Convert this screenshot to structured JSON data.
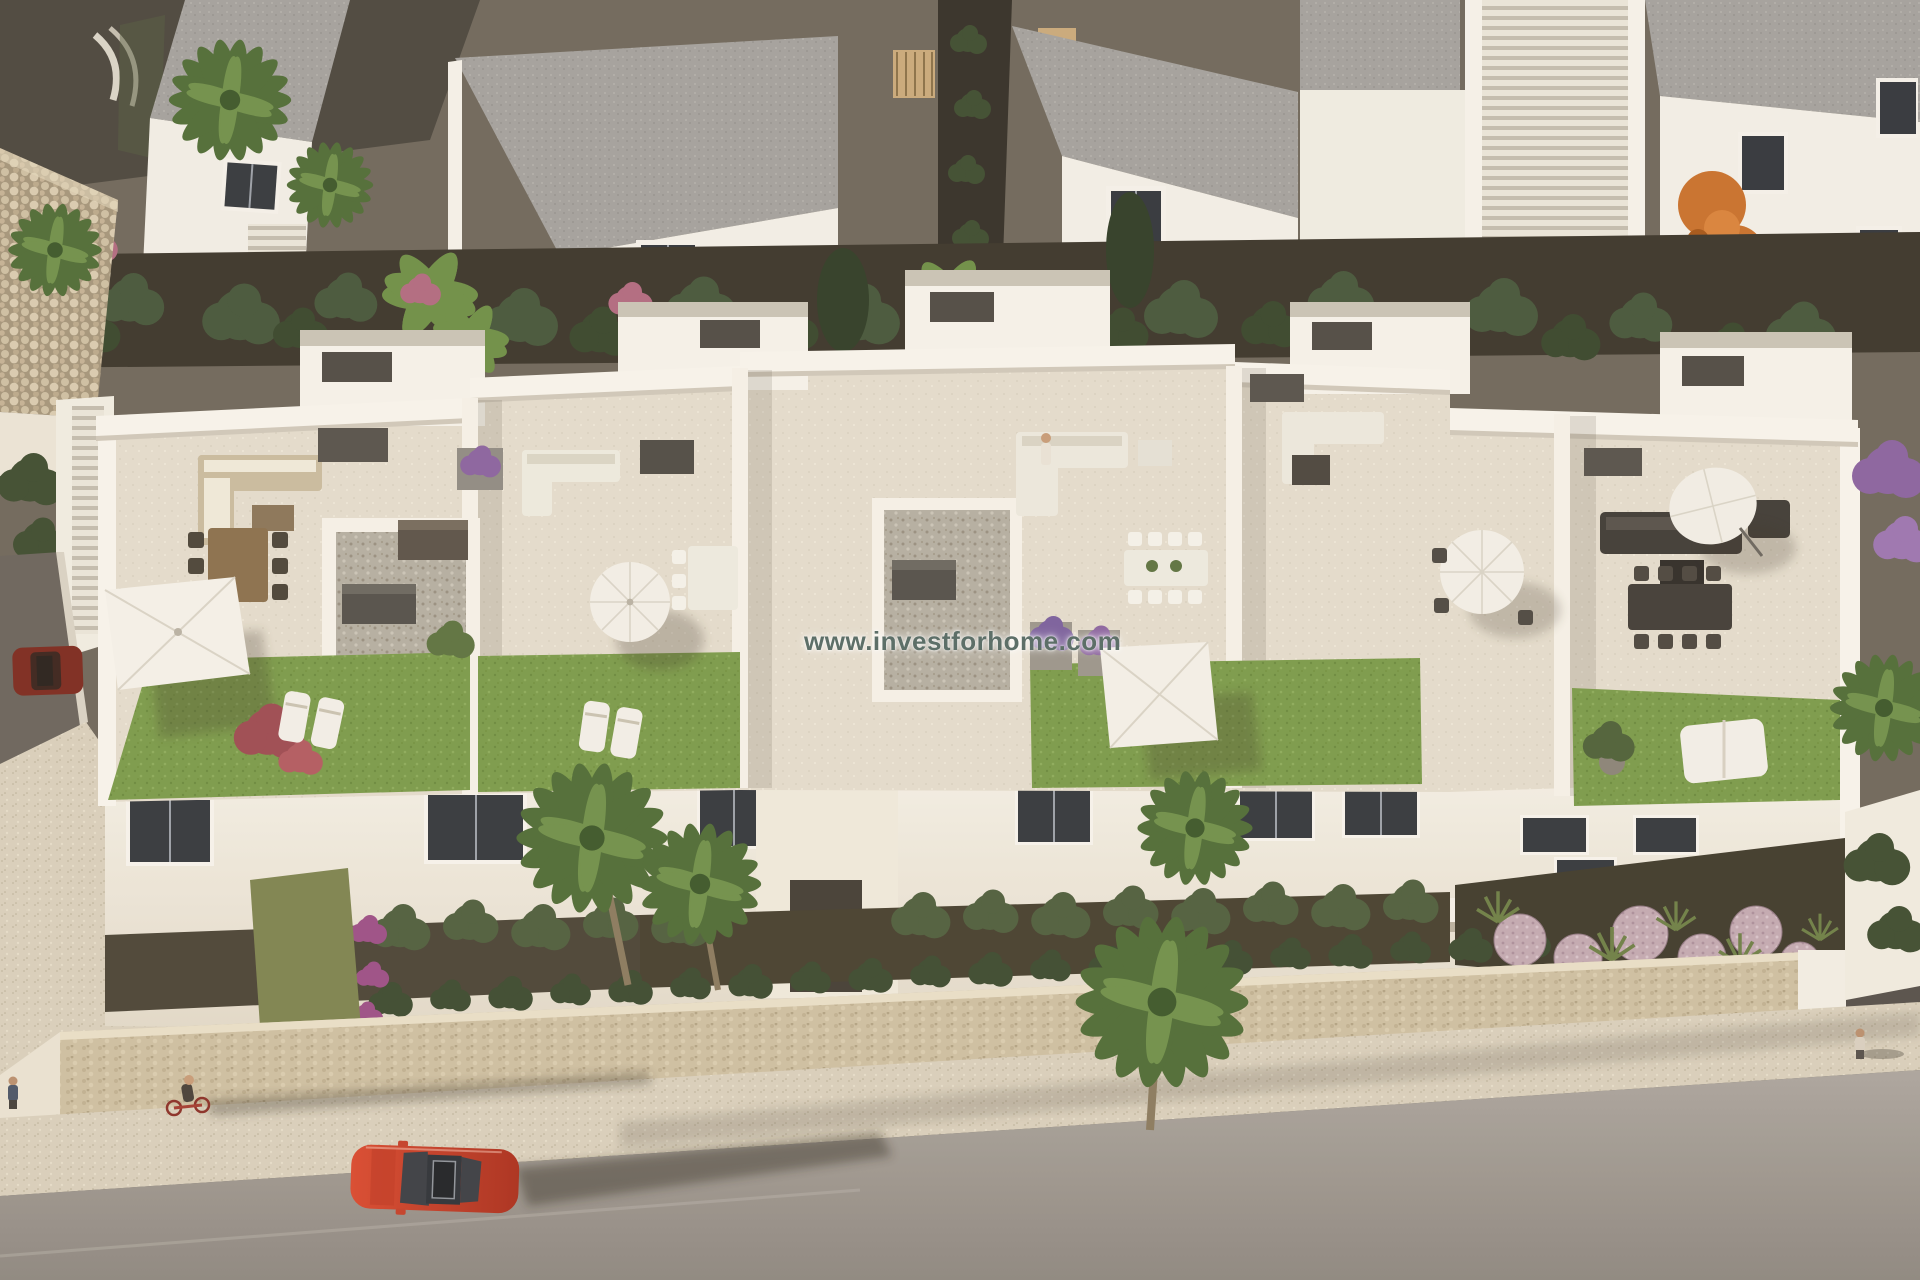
{
  "page": {
    "kind": "architectural-aerial-render",
    "description": "Aerial 3D visualisation of a new-build row of white Mediterranean townhouses with furnished rooftop solarium terraces, front gardens with palms and hedges, a sandstone perimeter wall and a street with a red car"
  },
  "watermark": {
    "text": "www.investforhome.com",
    "color": "#5d6f68",
    "glow": "#ffffff"
  },
  "palette": {
    "wall_white": "#f5f1e8",
    "wall_shadow": "#d9d1c2",
    "terrace_floor": "#e3dccd",
    "roof_gray": "#9a9894",
    "hedge_green": "#44543a",
    "grass_green": "#7a9a4a",
    "stone_wall": "#cdbfa2",
    "gravel": "#b4aea2",
    "street_asphalt": "#9e9892",
    "sidewalk": "#d8cfbc",
    "car_red": "#c8432c",
    "car_maroon": "#7c2a1f",
    "autumn_orange": "#c8702c",
    "bloom_pink": "#b06a80",
    "bloom_purple": "#8a62a0",
    "dark_path": "#3a362c"
  },
  "scene": {
    "lighting": "low warm sun from the left casting long shadows to the right",
    "background_row": {
      "elements": [
        "white villas with grey flat roofs",
        "dark tinted windows",
        "external staircases",
        "timber pergola slats",
        "dark gravel paths",
        "tall clipped hedges",
        "banana plants",
        "pink flowering shrubs",
        "orange autumn tree",
        "purple flowering tree",
        "stone gabion wall",
        "palm trees",
        "curved white steps"
      ]
    },
    "main_row": {
      "type": "five townhouse roof terraces (solariums) above a two-storey white facade",
      "units": [
        {
          "id": 1,
          "features": [
            "beige corner lounge sofa",
            "timber dining table with six dark chairs",
            "white square parasol",
            "artificial lawn",
            "red-leaf shrub",
            "white sun loungers",
            "anthracite planter boxes",
            "gravel patio with storage boxes",
            "side staircase"
          ]
        },
        {
          "id": 2,
          "features": [
            "white lounge sofa",
            "planter with purple flowers",
            "white round parasol",
            "white dining table",
            "white sun loungers",
            "lawn"
          ]
        },
        {
          "id": 3,
          "features": [
            "white corner sofa with chaise",
            "person sitting",
            "white dining table with eight chairs",
            "planters with purple flowers",
            "white square parasol",
            "lawn",
            "gravel court with AC units"
          ]
        },
        {
          "id": 4,
          "features": [
            "white corner sofa",
            "dark coffee table",
            "white round parasol with bistro set"
          ]
        },
        {
          "id": 5,
          "features": [
            "anthracite lounge set",
            "tilted round parasol",
            "anthracite dining table with eight chairs",
            "lawn",
            "white double sun lounger",
            "potted shrub"
          ]
        }
      ],
      "facade": [
        "white rendered walls",
        "dark aluminium windows",
        "white balcony band",
        "central staircase volume"
      ]
    },
    "foreground": {
      "gardens": [
        "clipped hedge rows",
        "palm trees",
        "purple bougainvillea",
        "ornamental bed with rose-coloured gravel mounds and spiky grasses"
      ],
      "boundary": [
        "sandstone perimeter wall with hedge on top",
        "white gate pillar",
        "white side wall",
        "dark paved driveway"
      ]
    },
    "street": {
      "elements": [
        "speckled stone sidewalk",
        "grey asphalt road",
        "long soft shadows"
      ],
      "vehicles": [
        {
          "type": "red sedan seen from above, parked on street",
          "color": "#c8432c"
        },
        {
          "type": "dark-red car parked on left side lane",
          "color": "#7c2a1f"
        }
      ],
      "people": [
        "cyclist with red bicycle",
        "pedestrian on left sidewalk",
        "pedestrian on right sidewalk",
        "person on roof terrace"
      ]
    }
  }
}
